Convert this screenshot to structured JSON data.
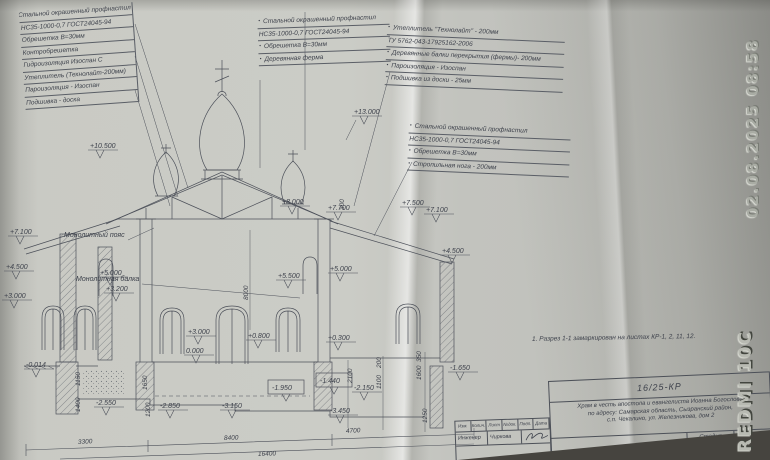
{
  "photo": {
    "timestamp": "02.08.2025 08:58",
    "camera_watermark": "REDMI 10C"
  },
  "spec_tables": {
    "left": {
      "rows": [
        {
          "t": "Стальной окрашенный профнастил",
          "b": false
        },
        {
          "t": "НС35-1000-0,7 ГОСТ24045-94",
          "b": false
        },
        {
          "t": "Обрешетка В=30мм",
          "b": false
        },
        {
          "t": "Контробрешетка",
          "b": false
        },
        {
          "t": "Гидроизоляция Изоспан С",
          "b": false
        },
        {
          "t": "Утеплитель (Технолайт-200мм)",
          "b": false
        },
        {
          "t": "Пароизоляция - Изоспан",
          "b": false
        },
        {
          "t": "Подшивка - доска",
          "b": false
        }
      ]
    },
    "center": {
      "rows": [
        {
          "t": "Стальной окрашенный профнастил",
          "b": true
        },
        {
          "t": "НС35-1000-0,7 ГОСТ24045-94",
          "b": false
        },
        {
          "t": "Обрешетка В=30мм",
          "b": true
        },
        {
          "t": "Деревянная ферма",
          "b": true
        }
      ]
    },
    "right": {
      "rows": [
        {
          "t": "Утеплитель \"Технолайт\" - 200мм",
          "b": true
        },
        {
          "t": "ТУ 5762-043-17925162-2006",
          "b": false
        },
        {
          "t": "Деревянные балки перекрытия (фермы)- 200мм",
          "b": true
        },
        {
          "t": "Пароизоляция - Изоспан",
          "b": true
        },
        {
          "t": "Подшивка из доски - 25мм",
          "b": true
        }
      ]
    },
    "mid": {
      "rows": [
        {
          "t": "Стальной окрашенный профнастил",
          "b": true
        },
        {
          "t": "НС35-1000-0,7 ГОСТ24045-94",
          "b": false
        },
        {
          "t": "Обрешетка В=30мм",
          "b": true
        },
        {
          "t": "Стропильная нога - 200мм",
          "b": true
        }
      ]
    }
  },
  "drawing": {
    "labels": {
      "belt": "Монолитный пояс",
      "beam": "Монолитная балка"
    },
    "note": "1. Разрез 1-1 замаркирован на листах КР-1, 2, 11, 12.",
    "elevation_marks": [
      {
        "v": "+13.000",
        "x": 352,
        "y": 116
      },
      {
        "v": "+10.500",
        "x": 88,
        "y": 150
      },
      {
        "v": "+8.000",
        "x": 280,
        "y": 206
      },
      {
        "v": "+7.700",
        "x": 326,
        "y": 212
      },
      {
        "v": "+7.500",
        "x": 400,
        "y": 207
      },
      {
        "v": "+7.100",
        "x": 424,
        "y": 214
      },
      {
        "v": "+7.100",
        "x": 8,
        "y": 236
      },
      {
        "v": "+4.500",
        "x": 4,
        "y": 271
      },
      {
        "v": "+3.000",
        "x": 2,
        "y": 300
      },
      {
        "v": "+5.000",
        "x": 98,
        "y": 277
      },
      {
        "v": "+3.200",
        "x": 104,
        "y": 293
      },
      {
        "v": "+5.500",
        "x": 276,
        "y": 280
      },
      {
        "v": "+5.000",
        "x": 328,
        "y": 273
      },
      {
        "v": "+4.500",
        "x": 440,
        "y": 255
      },
      {
        "v": "+3.000",
        "x": 186,
        "y": 336
      },
      {
        "v": "+0.800",
        "x": 246,
        "y": 340
      },
      {
        "v": "+0.300",
        "x": 326,
        "y": 342
      },
      {
        "v": "0.000",
        "x": 184,
        "y": 355
      },
      {
        "v": "-0.014",
        "x": 24,
        "y": 369
      },
      {
        "v": "-2.550",
        "x": 94,
        "y": 407
      },
      {
        "v": "-2.850",
        "x": 158,
        "y": 410
      },
      {
        "v": "-3.150",
        "x": 220,
        "y": 410
      },
      {
        "v": "-2.150",
        "x": 352,
        "y": 392
      },
      {
        "v": "-3.450",
        "x": 328,
        "y": 415
      },
      {
        "v": "-1.650",
        "x": 448,
        "y": 372
      }
    ],
    "boxed_marks": [
      {
        "v": "-1.950",
        "x": 268,
        "y": 380
      },
      {
        "v": "-1.440",
        "x": 316,
        "y": 373
      }
    ],
    "dim_h": [
      {
        "v": "3300",
        "x": 78,
        "y": 444,
        "r": -3
      },
      {
        "v": "8400",
        "x": 224,
        "y": 440,
        "r": -2
      },
      {
        "v": "4700",
        "x": 346,
        "y": 433,
        "r": -3
      },
      {
        "v": "16400",
        "x": 258,
        "y": 456,
        "r": -2
      }
    ],
    "dim_v": [
      {
        "v": "8000",
        "x": 248,
        "y": 300
      },
      {
        "v": "300",
        "x": 344,
        "y": 210
      },
      {
        "v": "1650",
        "x": 147,
        "y": 390
      },
      {
        "v": "1200",
        "x": 150,
        "y": 417
      },
      {
        "v": "1150",
        "x": 80,
        "y": 386
      },
      {
        "v": "1400",
        "x": 80,
        "y": 412
      },
      {
        "v": "2100",
        "x": 352,
        "y": 383
      },
      {
        "v": "200",
        "x": 381,
        "y": 368
      },
      {
        "v": "1100",
        "x": 381,
        "y": 389
      },
      {
        "v": "350",
        "x": 421,
        "y": 362
      },
      {
        "v": "1600",
        "x": 421,
        "y": 380
      },
      {
        "v": "1250",
        "x": 427,
        "y": 423
      }
    ]
  },
  "title_block": {
    "doc_number": "16/25-КР",
    "project_lines": {
      "l1": "Храм в честь апостола и евангелиста Иоанна Богослова",
      "l2": "по адресу: Самарская область, Сызранский район,",
      "l3": "с.п. Чекалино, ул. Железникова, дом 2"
    },
    "stage_label": "Стадия",
    "sheet_label": "Лист",
    "stage_value": "П",
    "sheet_value": "3",
    "rev_columns": [
      "Изм.",
      "Колич.",
      "Лист",
      "№док.",
      "Подп.",
      "Дата"
    ],
    "engineer_label": "Инженер",
    "engineer_name": "Чиркова"
  }
}
